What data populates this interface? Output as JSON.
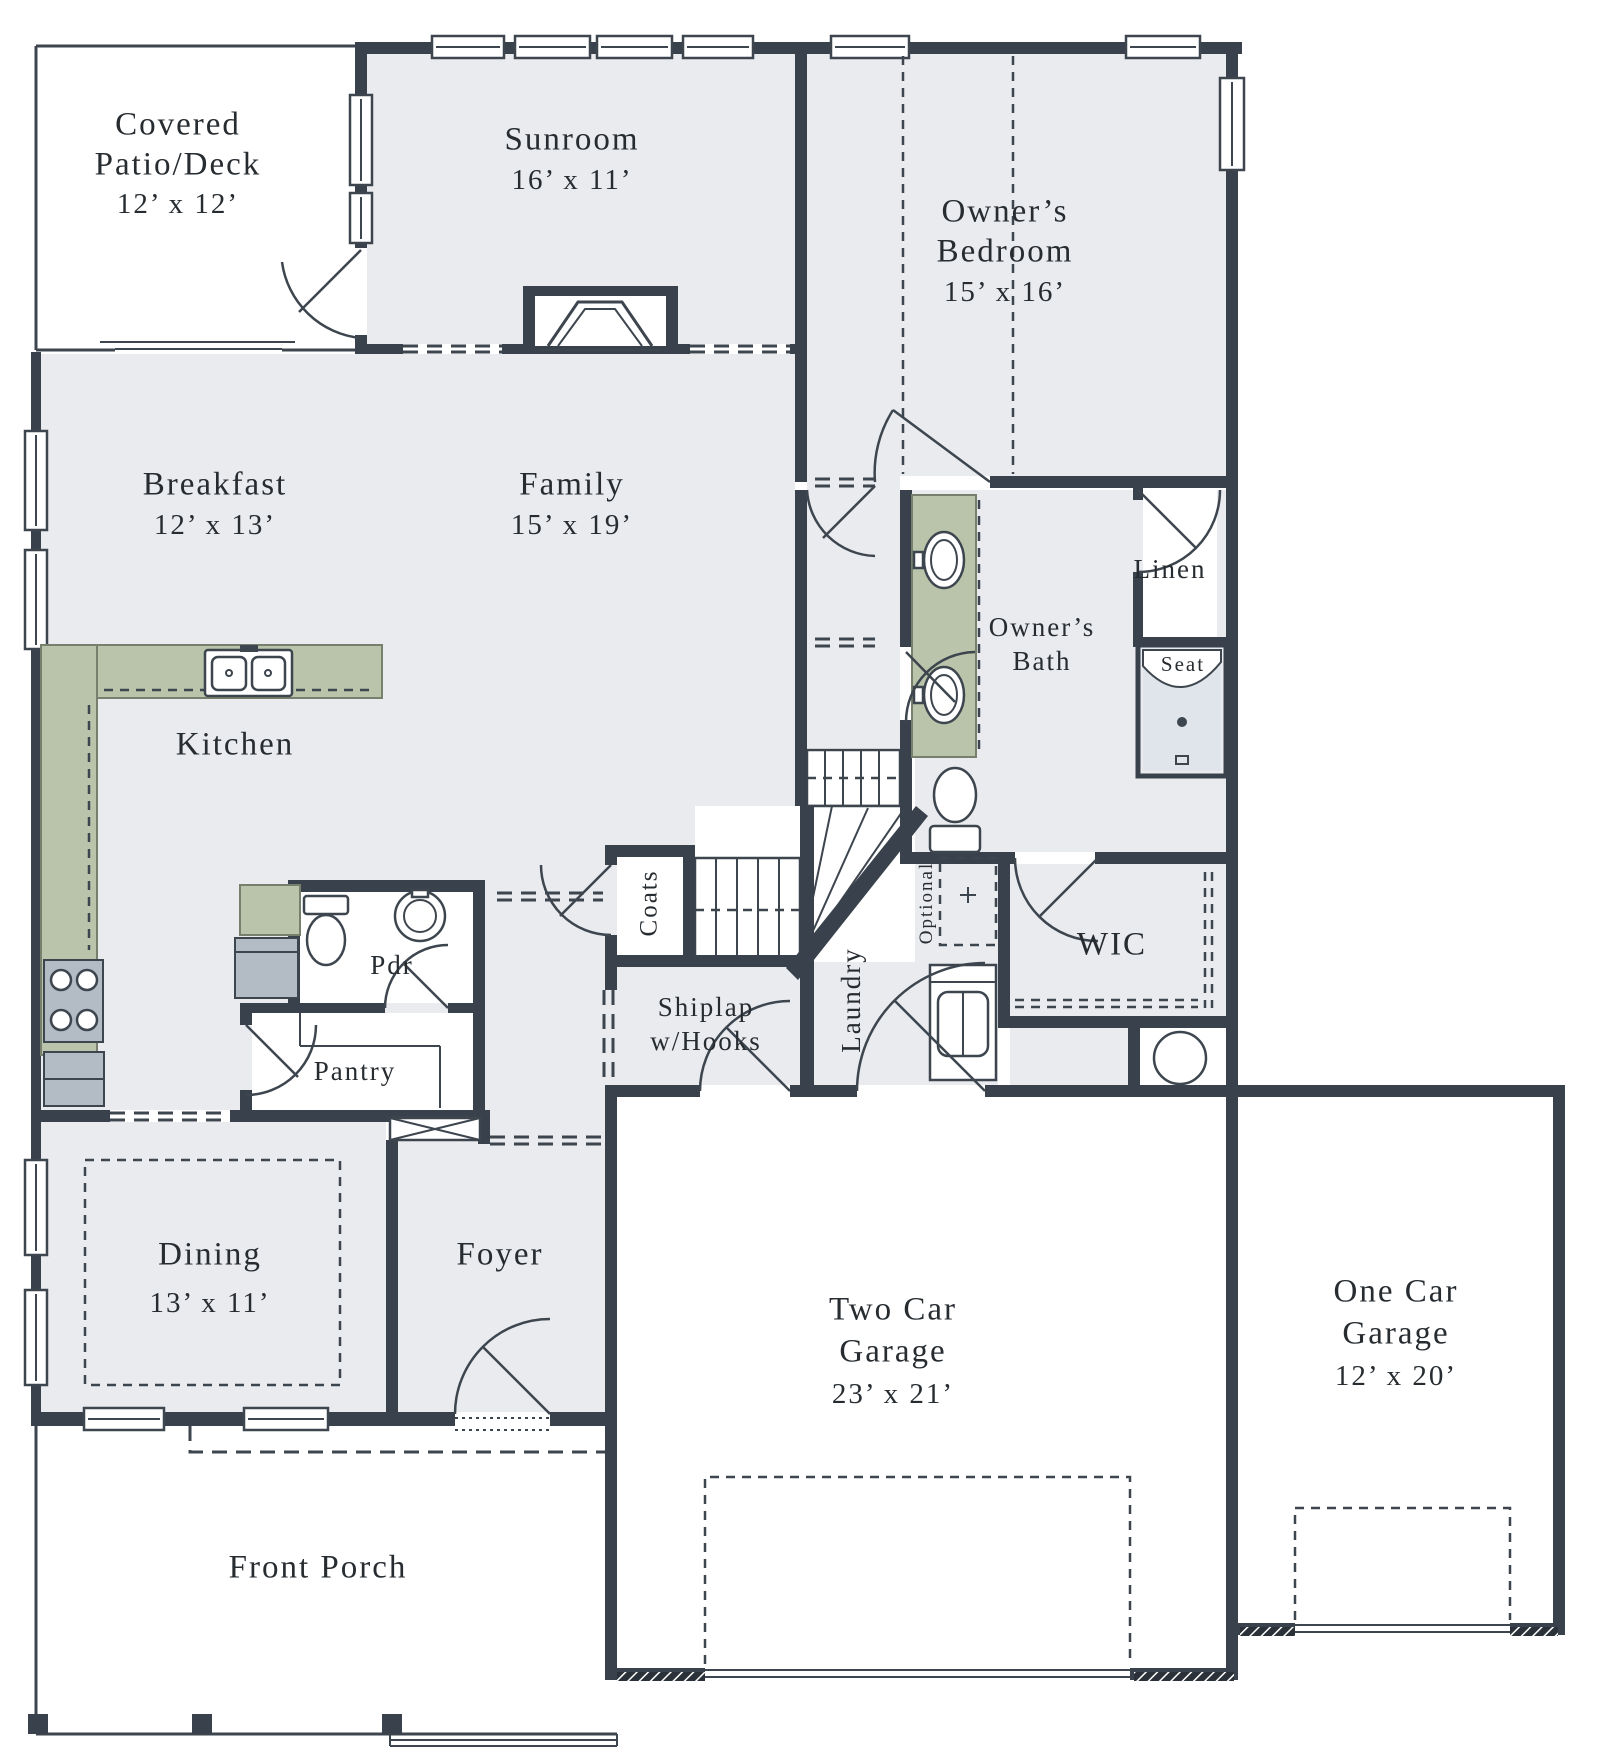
{
  "title": "First floor plan",
  "colors": {
    "wall": "#39424c",
    "floor": "#e9ebef",
    "line": "#3d454e",
    "counter": "#b9c4aa",
    "counter_edge": "#77806c",
    "appliance": "#b3bcc4",
    "shower": "#dfe5ea",
    "text": "#272c31"
  },
  "rooms": {
    "patio": {
      "line1": "Covered",
      "line2": "Patio/Deck",
      "dims": "12’ x 12’"
    },
    "sunroom": {
      "name": "Sunroom",
      "dims": "16’ x 11’"
    },
    "bedroom": {
      "line1": "Owner’s",
      "line2": "Bedroom",
      "dims": "15’ x 16’"
    },
    "breakfast": {
      "name": "Breakfast",
      "dims": "12’ x 13’"
    },
    "family": {
      "name": "Family",
      "dims": "15’ x 19’"
    },
    "kitchen": {
      "name": "Kitchen"
    },
    "linen": {
      "name": "Linen"
    },
    "bath": {
      "line1": "Owner’s",
      "line2": "Bath"
    },
    "seat": {
      "name": "Seat"
    },
    "wic": {
      "name": "WIC"
    },
    "coats": {
      "name": "Coats"
    },
    "shiplap": {
      "line1": "Shiplap",
      "line2": "w/Hooks"
    },
    "laundry": {
      "name": "Laundry"
    },
    "optional": {
      "name": "Optional"
    },
    "pdr": {
      "name": "Pdr"
    },
    "pantry": {
      "name": "Pantry"
    },
    "dining": {
      "name": "Dining",
      "dims": "13’ x 11’"
    },
    "foyer": {
      "name": "Foyer"
    },
    "garage2": {
      "line1": "Two Car",
      "line2": "Garage",
      "dims": "23’ x 21’"
    },
    "garage1": {
      "line1": "One Car",
      "line2": "Garage",
      "dims": "12’ x 20’"
    },
    "porch": {
      "name": "Front Porch"
    }
  }
}
